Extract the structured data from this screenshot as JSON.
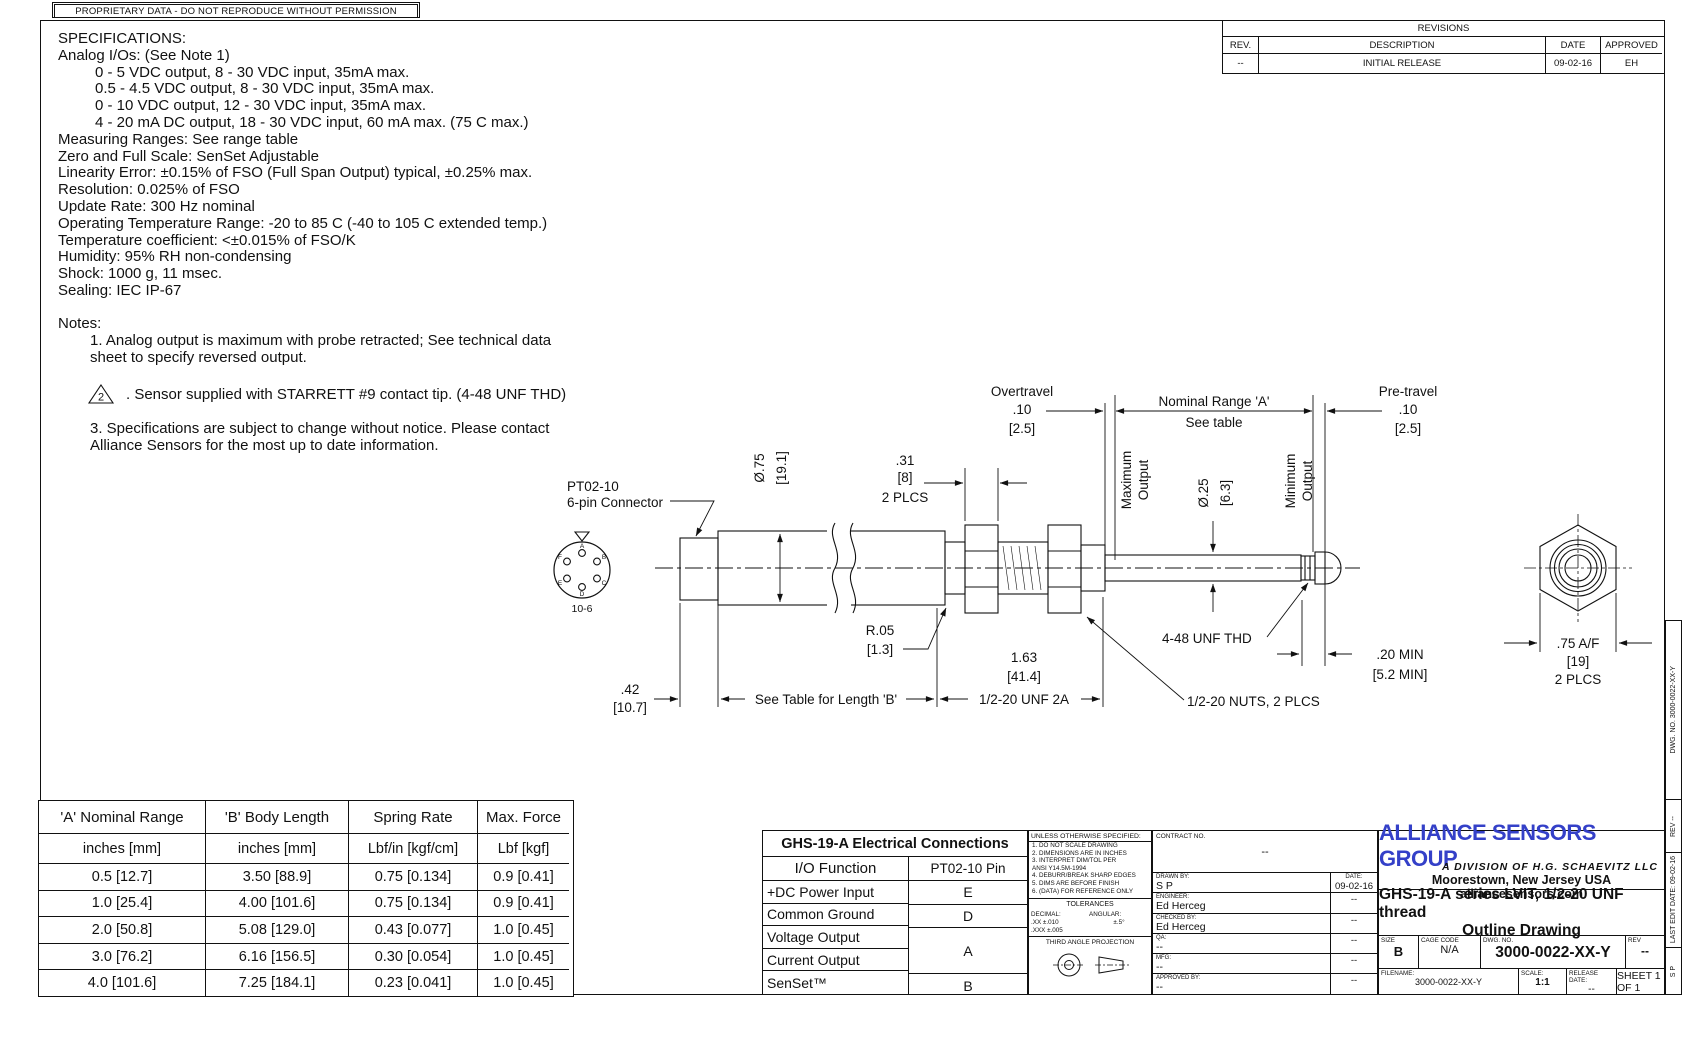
{
  "banner": {
    "text": "PROPRIETARY DATA - DO NOT REPRODUCE WITHOUT PERMISSION"
  },
  "revisions": {
    "title": "REVISIONS",
    "headers": {
      "rev": "REV.",
      "description": "DESCRIPTION",
      "date": "DATE",
      "approved": "APPROVED"
    },
    "rows": [
      {
        "rev": "--",
        "description": "INITIAL RELEASE",
        "date": "09-02-16",
        "approved": "EH"
      }
    ]
  },
  "specifications": {
    "title": "SPECIFICATIONS:",
    "subtitle": "Analog I/Os: (See Note 1)",
    "io_options": [
      "0 - 5 VDC output, 8 - 30 VDC input, 35mA max.",
      "0.5 - 4.5 VDC output, 8 - 30 VDC input, 35mA max.",
      "0 - 10 VDC output, 12 - 30 VDC input, 35mA max.",
      "4 - 20 mA DC output, 18 - 30 VDC input, 60 mA max. (75 C max.)"
    ],
    "lines": [
      "Measuring Ranges: See range table",
      "Zero and Full Scale: SenSet Adjustable",
      "Linearity Error: ±0.15% of FSO (Full Span Output) typical, ±0.25% max.",
      "Resolution: 0.025% of FSO",
      "Update Rate: 300 Hz nominal",
      "Operating Temperature Range: -20 to 85 C (-40 to 105 C extended temp.)",
      "Temperature coefficient: <±0.015% of FSO/K",
      "Humidity: 95% RH non-condensing",
      "Shock: 1000 g, 11 msec.",
      "Sealing: IEC IP-67"
    ]
  },
  "notes": {
    "title": "Notes:",
    "note1_line1": "1. Analog output is maximum with probe retracted; See technical data",
    "note1_line2": "sheet to specify reversed output.",
    "note2_flag": "2",
    "note2_text": ". Sensor supplied with STARRETT #9 contact tip. (4-48 UNF THD)",
    "note3_line1": "3. Specifications are subject to change without notice. Please contact",
    "note3_line2": "Alliance Sensors for the most up to date information."
  },
  "drawing": {
    "connector_label": [
      "PT02-10",
      "6-pin Connector"
    ],
    "connector_view_label": "10-6",
    "pins": [
      "A",
      "B",
      "C",
      "D",
      "E",
      "F"
    ],
    "dims": {
      "dia_body": [
        "Ø.75",
        "[19.1]"
      ],
      "nut_thk": [
        ".31",
        "[8]",
        "2 PLCS"
      ],
      "overtravel": [
        "Overtravel",
        ".10",
        "[2.5]"
      ],
      "nominal": [
        "Nominal Range 'A'",
        "See table"
      ],
      "pretravel": [
        "Pre-travel",
        ".10",
        "[2.5]"
      ],
      "max_output": [
        "Maximum",
        "Output"
      ],
      "min_output": [
        "Minimum",
        "Output"
      ],
      "dia_rod": [
        "Ø.25",
        "[6.3]"
      ],
      "radius": [
        "R.05",
        "[1.3]"
      ],
      "rear": [
        ".42",
        "[10.7]"
      ],
      "length_b": "See Table for Length 'B'",
      "body_len": [
        "1.63",
        "[41.4]"
      ],
      "thread": "1/2-20 UNF 2A",
      "tip_thread": "4-48 UNF THD",
      "nuts": "1/2-20 NUTS, 2 PLCS",
      "min20": [
        ".20 MIN",
        "[5.2 MIN]"
      ],
      "hex_af": [
        ".75 A/F",
        "[19]",
        "2 PLCS"
      ]
    }
  },
  "range_table": {
    "headers": [
      "'A' Nominal Range",
      "'B' Body Length",
      "Spring Rate",
      "Max. Force"
    ],
    "units": [
      "inches [mm]",
      "inches [mm]",
      "Lbf/in [kgf/cm]",
      "Lbf [kgf]"
    ],
    "rows": [
      [
        "0.5 [12.7]",
        "3.50 [88.9]",
        "0.75 [0.134]",
        "0.9 [0.41]"
      ],
      [
        "1.0 [25.4]",
        "4.00 [101.6]",
        "0.75 [0.134]",
        "0.9 [0.41]"
      ],
      [
        "2.0 [50.8]",
        "5.08 [129.0]",
        "0.43 [0.077]",
        "1.0 [0.45]"
      ],
      [
        "3.0 [76.2]",
        "6.16 [156.5]",
        "0.30 [0.054]",
        "1.0 [0.45]"
      ],
      [
        "4.0 [101.6]",
        "7.25 [184.1]",
        "0.23 [0.041]",
        "1.0 [0.45]"
      ]
    ]
  },
  "electrical": {
    "title": "GHS-19-A Electrical Connections",
    "headers": [
      "I/O Function",
      "PT02-10 Pin"
    ],
    "row_power": "+DC Power Input",
    "pin_power": "E",
    "row_ground": "Common Ground",
    "pin_ground": "D",
    "row_voltage": "Voltage Output",
    "row_current": "Current Output",
    "pin_va": "A",
    "row_senset": "SenSet™",
    "pin_senset": "B"
  },
  "title_block": {
    "unless": "UNLESS OTHERWISE SPECIFIED:",
    "spec_notes": [
      "1. DO NOT SCALE DRAWING",
      "2. DIMENSIONS ARE IN INCHES",
      "3. INTERPRET DIM/TOL PER",
      "    ANSI Y14.5M-1994",
      "4. DEBURR/BREAK SHARP EDGES",
      "5. DIMS ARE BEFORE FINISH",
      "6. (DATA) FOR REFERENCE ONLY"
    ],
    "tolerances_title": "TOLERANCES",
    "decimal_label": "DECIMAL:",
    "decimal_xx": ".XX    ±.010",
    "decimal_xxx": ".XXX  ±.005",
    "angular_label": "ANGULAR:",
    "angular_val": "±.5°",
    "projection": "THIRD ANGLE PROJECTION",
    "contract_label": "CONTRACT NO.",
    "contract_val": "--",
    "rows": [
      {
        "label": "DRAWN BY:",
        "name": "S P",
        "right_label": "DATE:",
        "right": "09-02-16"
      },
      {
        "label": "ENGINEER:",
        "name": "Ed Herceg",
        "right_label": "",
        "right": "--"
      },
      {
        "label": "CHECKED BY:",
        "name": "Ed Herceg",
        "right_label": "",
        "right": "--"
      },
      {
        "label": "QA:",
        "name": "--",
        "right_label": "",
        "right": "--"
      },
      {
        "label": "MFG:",
        "name": "--",
        "right_label": "",
        "right": "--"
      },
      {
        "label": "APPROVED BY:",
        "name": "--",
        "right_label": "",
        "right": "--"
      }
    ],
    "logo": "ALLIANCE SENSORS GROUP",
    "division": "A DIVISION OF H.G. SCHAEVITZ LLC",
    "address": "Moorestown, New Jersey  USA  alliancesensors.com",
    "title_line1": "GHS-19-A series LVIT, 1/2-20 UNF thread",
    "title_line2": "Outline Drawing",
    "size_label": "SIZE",
    "size": "B",
    "cage_label": "CAGE CODE",
    "cage": "N/A",
    "dwgno_label": "DWG. NO.",
    "dwgno": "3000-0022-XX-Y",
    "rev_label": "REV",
    "rev": "--",
    "filename_label": "FILENAME:",
    "filename": "3000-0022-XX-Y",
    "scale_label": "SCALE:",
    "scale": "1:1",
    "release_label": "RELEASE DATE:",
    "release": "--",
    "sheet": "SHEET 1 OF 1"
  },
  "side_strip": {
    "dwgno": "DWG. NO.   3000-0022-XX-Y",
    "rev": "REV   --",
    "last_edit": "LAST EDIT DATE:  09-02-16",
    "by": "S P"
  },
  "colors": {
    "logo_blue": "#3440c8",
    "line": "#111111"
  }
}
